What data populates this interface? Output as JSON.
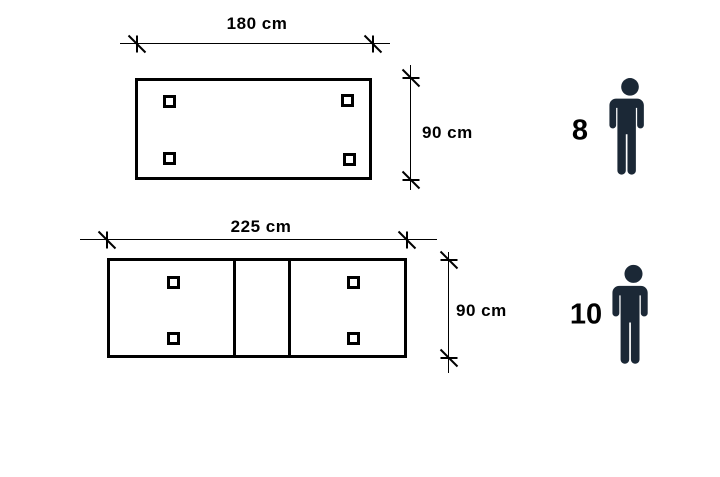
{
  "diagram": {
    "description": "Dining table size and seating capacity diagram (top view)",
    "tables": [
      {
        "name": "table-180",
        "width_label": "180 cm",
        "depth_label": "90 cm",
        "capacity": "8",
        "legs": 4,
        "extension_leaf": false,
        "icon": "person-icon"
      },
      {
        "name": "table-225-extended",
        "width_label": "225 cm",
        "depth_label": "90 cm",
        "capacity": "10",
        "legs": 4,
        "extension_leaf": true,
        "icon": "person-icon"
      }
    ],
    "colors": {
      "background": "#ffffff",
      "line": "#000000",
      "text": "#000000",
      "person": "#1b2836"
    }
  }
}
